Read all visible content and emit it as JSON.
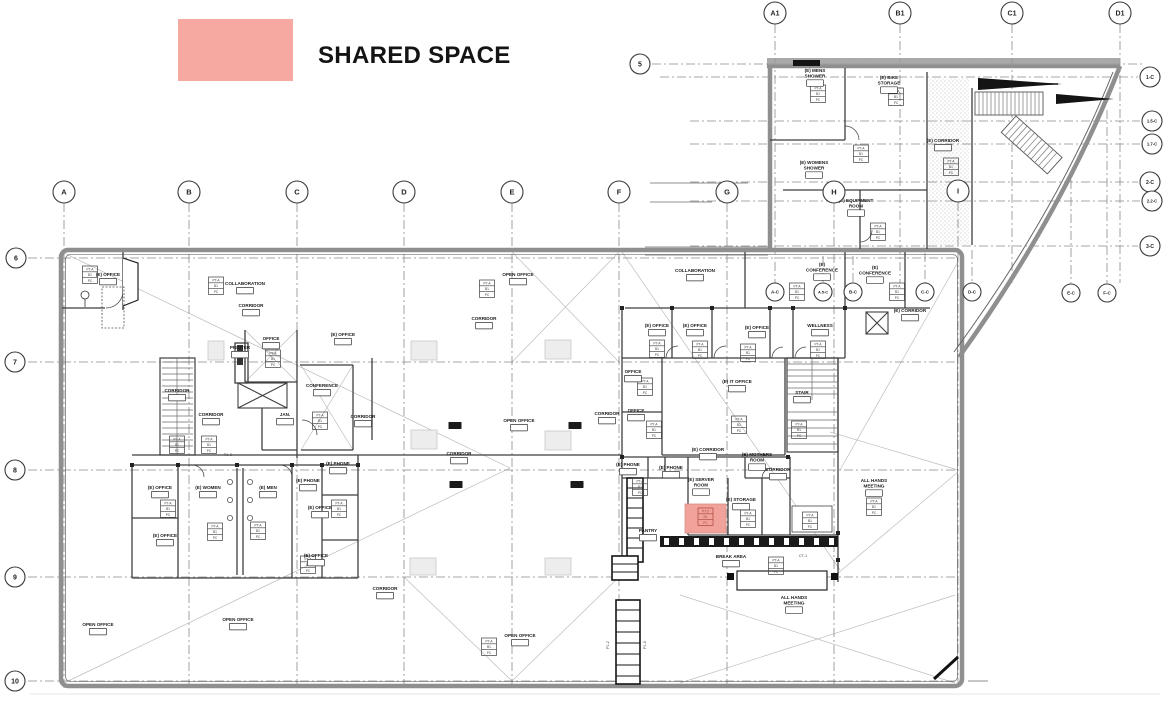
{
  "legend": {
    "label": "SHARED SPACE",
    "swatch_color": "#F5A9A1"
  },
  "highlight": {
    "x": 685,
    "y": 504,
    "w": 41,
    "h": 29,
    "fill": "#F1A39B",
    "stroke": "#D98D86",
    "tag_rows": [
      "PT-5",
      "B1",
      "PC"
    ],
    "tag_color": "#A8453C"
  },
  "finish_tag_rows": [
    "PT-A",
    "B1",
    "PC"
  ],
  "grid_bubbles": [
    {
      "id": "A1",
      "x": 775,
      "y": 13,
      "r": 11,
      "fs": 7
    },
    {
      "id": "B1",
      "x": 900,
      "y": 13,
      "r": 11,
      "fs": 7
    },
    {
      "id": "C1",
      "x": 1012,
      "y": 13,
      "r": 11,
      "fs": 7
    },
    {
      "id": "D1",
      "x": 1120,
      "y": 13,
      "r": 11,
      "fs": 7
    },
    {
      "id": "5",
      "x": 640,
      "y": 64,
      "r": 10,
      "fs": 7
    },
    {
      "id": "6",
      "x": 16,
      "y": 258,
      "r": 10,
      "fs": 7
    },
    {
      "id": "7",
      "x": 15,
      "y": 362,
      "r": 10,
      "fs": 7
    },
    {
      "id": "8",
      "x": 15,
      "y": 470,
      "r": 10,
      "fs": 7
    },
    {
      "id": "9",
      "x": 15,
      "y": 577,
      "r": 10,
      "fs": 7
    },
    {
      "id": "10",
      "x": 15,
      "y": 681,
      "r": 10,
      "fs": 7
    },
    {
      "id": "A",
      "x": 64,
      "y": 192,
      "r": 11,
      "fs": 7.5
    },
    {
      "id": "B",
      "x": 189,
      "y": 192,
      "r": 11,
      "fs": 7.5
    },
    {
      "id": "C",
      "x": 297,
      "y": 192,
      "r": 11,
      "fs": 7.5
    },
    {
      "id": "D",
      "x": 404,
      "y": 192,
      "r": 11,
      "fs": 7.5
    },
    {
      "id": "E",
      "x": 512,
      "y": 192,
      "r": 11,
      "fs": 7.5
    },
    {
      "id": "F",
      "x": 619,
      "y": 192,
      "r": 11,
      "fs": 7.5
    },
    {
      "id": "G",
      "x": 727,
      "y": 192,
      "r": 11,
      "fs": 7.5
    },
    {
      "id": "H",
      "x": 834,
      "y": 192,
      "r": 11,
      "fs": 7.5
    },
    {
      "id": "I",
      "x": 958,
      "y": 191,
      "r": 11,
      "fs": 7.5
    },
    {
      "id": "1-C",
      "x": 1150,
      "y": 77,
      "r": 10,
      "fs": 5
    },
    {
      "id": "1.5-C",
      "x": 1152,
      "y": 121,
      "r": 10,
      "fs": 4.2
    },
    {
      "id": "1.7-C",
      "x": 1152,
      "y": 144,
      "r": 10,
      "fs": 4.2
    },
    {
      "id": "2-C",
      "x": 1150,
      "y": 182,
      "r": 10,
      "fs": 5
    },
    {
      "id": "2.2-C",
      "x": 1152,
      "y": 201,
      "r": 10,
      "fs": 4.2
    },
    {
      "id": "3-C",
      "x": 1150,
      "y": 246,
      "r": 10,
      "fs": 5
    },
    {
      "id": "A-C",
      "x": 775,
      "y": 292,
      "r": 9,
      "fs": 4.5
    },
    {
      "id": "A.5-C",
      "x": 823,
      "y": 292,
      "r": 9,
      "fs": 3.8
    },
    {
      "id": "B-C",
      "x": 853,
      "y": 292,
      "r": 9,
      "fs": 4.5
    },
    {
      "id": "C-C",
      "x": 925,
      "y": 292,
      "r": 9,
      "fs": 4.5
    },
    {
      "id": "D-C",
      "x": 972,
      "y": 292,
      "r": 9,
      "fs": 4.5
    },
    {
      "id": "E-C",
      "x": 1071,
      "y": 293,
      "r": 9,
      "fs": 4.5
    },
    {
      "id": "F-C",
      "x": 1107,
      "y": 293,
      "r": 9,
      "fs": 4.5
    }
  ],
  "rooms": [
    {
      "t": "(E) OFFICE",
      "x": 108,
      "y": 272
    },
    {
      "t": "COLLABORATION",
      "x": 245,
      "y": 281
    },
    {
      "t": "CORRIDOR",
      "x": 251,
      "y": 303
    },
    {
      "t": "PRINTER",
      "x": 240,
      "y": 345
    },
    {
      "t": "OFFICE",
      "x": 271,
      "y": 336
    },
    {
      "t": "(E) OFFICE",
      "x": 343,
      "y": 332
    },
    {
      "t": "CONFERENCE",
      "x": 322,
      "y": 383
    },
    {
      "t": "CORRIDOR",
      "x": 177,
      "y": 388
    },
    {
      "t": "CORRIDOR",
      "x": 211,
      "y": 412
    },
    {
      "t": "JAN.",
      "x": 285,
      "y": 412
    },
    {
      "t": "CORRIDOR",
      "x": 363,
      "y": 414
    },
    {
      "t": "(E) PHONE",
      "x": 338,
      "y": 461
    },
    {
      "t": "(E) OFFICE",
      "x": 160,
      "y": 485
    },
    {
      "t": "(E) WOMEN",
      "x": 208,
      "y": 485
    },
    {
      "t": "(E) MEN",
      "x": 268,
      "y": 485
    },
    {
      "t": "(E) PHONE",
      "x": 308,
      "y": 478
    },
    {
      "t": "(E) OFFICE",
      "x": 320,
      "y": 505
    },
    {
      "t": "(E) OFFICE",
      "x": 165,
      "y": 533
    },
    {
      "t": "(E) OFFICE",
      "x": 316,
      "y": 553
    },
    {
      "t": "OPEN OFFICE",
      "x": 98,
      "y": 622
    },
    {
      "t": "OPEN OFFICE",
      "x": 238,
      "y": 617
    },
    {
      "t": "OPEN OFFICE",
      "x": 518,
      "y": 272
    },
    {
      "t": "CORRIDOR",
      "x": 484,
      "y": 316
    },
    {
      "t": "OPEN OFFICE",
      "x": 519,
      "y": 418
    },
    {
      "t": "CORRIDOR",
      "x": 607,
      "y": 411
    },
    {
      "t": "CORRIDOR",
      "x": 459,
      "y": 451
    },
    {
      "t": "CORRIDOR",
      "x": 385,
      "y": 586
    },
    {
      "t": "OPEN OFFICE",
      "x": 520,
      "y": 633
    },
    {
      "t": "COLLABORATION",
      "x": 695,
      "y": 268
    },
    {
      "t": "(E)|CONFERENCE",
      "x": 822,
      "y": 262
    },
    {
      "t": "(E)|CONFERENCE",
      "x": 875,
      "y": 265
    },
    {
      "t": "(E) OFFICE",
      "x": 657,
      "y": 323
    },
    {
      "t": "(E) OFFICE",
      "x": 695,
      "y": 323
    },
    {
      "t": "(E) OFFICE",
      "x": 757,
      "y": 325
    },
    {
      "t": "WELLNESS",
      "x": 820,
      "y": 323
    },
    {
      "t": "OFFICE",
      "x": 633,
      "y": 369
    },
    {
      "t": "(E) IT OFFICE",
      "x": 737,
      "y": 379
    },
    {
      "t": "STAIR",
      "x": 802,
      "y": 390
    },
    {
      "t": "OFFICE",
      "x": 636,
      "y": 408
    },
    {
      "t": "(E) CORRIDOR",
      "x": 708,
      "y": 447
    },
    {
      "t": "(E) MOTHERS|ROOM",
      "x": 757,
      "y": 452
    },
    {
      "t": "CORRIDOR",
      "x": 778,
      "y": 467
    },
    {
      "t": "(E) PHONE",
      "x": 628,
      "y": 462
    },
    {
      "t": "(E) PHONE",
      "x": 671,
      "y": 465
    },
    {
      "t": "(E) SERVER|ROOM",
      "x": 701,
      "y": 477
    },
    {
      "t": "(E) STORAGE",
      "x": 741,
      "y": 497
    },
    {
      "t": "PANTRY",
      "x": 648,
      "y": 528
    },
    {
      "t": "BREAK AREA",
      "x": 731,
      "y": 554
    },
    {
      "t": "ALL HANDS|MEETING",
      "x": 874,
      "y": 478
    },
    {
      "t": "ALL HANDS|MEETING",
      "x": 794,
      "y": 595
    },
    {
      "t": "(E) CORRIDOR",
      "x": 910,
      "y": 308
    },
    {
      "t": "(E) MENS|SHOWER",
      "x": 815,
      "y": 68
    },
    {
      "t": "(E) BIKE|STORAGE",
      "x": 889,
      "y": 75
    },
    {
      "t": "(E) CORRIDOR",
      "x": 943,
      "y": 138
    },
    {
      "t": "(E) WOMENS|SHOWER",
      "x": 814,
      "y": 160
    },
    {
      "t": "(E) EQUIPMENT|ROOM",
      "x": 856,
      "y": 198
    }
  ],
  "finish_tags": [
    [
      90,
      266
    ],
    [
      216,
      277
    ],
    [
      487,
      280
    ],
    [
      273,
      350
    ],
    [
      320,
      412
    ],
    [
      177,
      436
    ],
    [
      209,
      436
    ],
    [
      168,
      500
    ],
    [
      215,
      523
    ],
    [
      258,
      522
    ],
    [
      308,
      556
    ],
    [
      339,
      500
    ],
    [
      489,
      638
    ],
    [
      657,
      340
    ],
    [
      700,
      341
    ],
    [
      748,
      344
    ],
    [
      818,
      341
    ],
    [
      739,
      416
    ],
    [
      645,
      378
    ],
    [
      654,
      421
    ],
    [
      799,
      421
    ],
    [
      797,
      283
    ],
    [
      897,
      283
    ],
    [
      818,
      85
    ],
    [
      896,
      88
    ],
    [
      861,
      145
    ],
    [
      951,
      158
    ],
    [
      878,
      223
    ],
    [
      810,
      512
    ],
    [
      874,
      498
    ],
    [
      748,
      510
    ],
    [
      776,
      557
    ],
    [
      640,
      478
    ]
  ],
  "dark_tags": [
    [
      455,
      422
    ],
    [
      575,
      422
    ],
    [
      456,
      481
    ],
    [
      577,
      481
    ]
  ],
  "gray_boxes": [
    [
      411,
      341,
      26,
      19
    ],
    [
      545,
      340,
      26,
      19
    ],
    [
      411,
      430,
      26,
      19
    ],
    [
      545,
      431,
      26,
      19
    ],
    [
      410,
      558,
      26,
      17
    ],
    [
      545,
      558,
      26,
      17
    ],
    [
      208,
      341,
      16,
      19
    ]
  ],
  "misc_labels": [
    {
      "t": "P1-C",
      "x": 228,
      "y": 456,
      "rot": 0
    },
    {
      "t": "CT-1",
      "x": 803,
      "y": 557,
      "rot": 0
    },
    {
      "t": "P1-2",
      "x": 609,
      "y": 645,
      "rot": -90
    },
    {
      "t": "P1-0",
      "x": 646,
      "y": 645,
      "rot": -90
    }
  ]
}
